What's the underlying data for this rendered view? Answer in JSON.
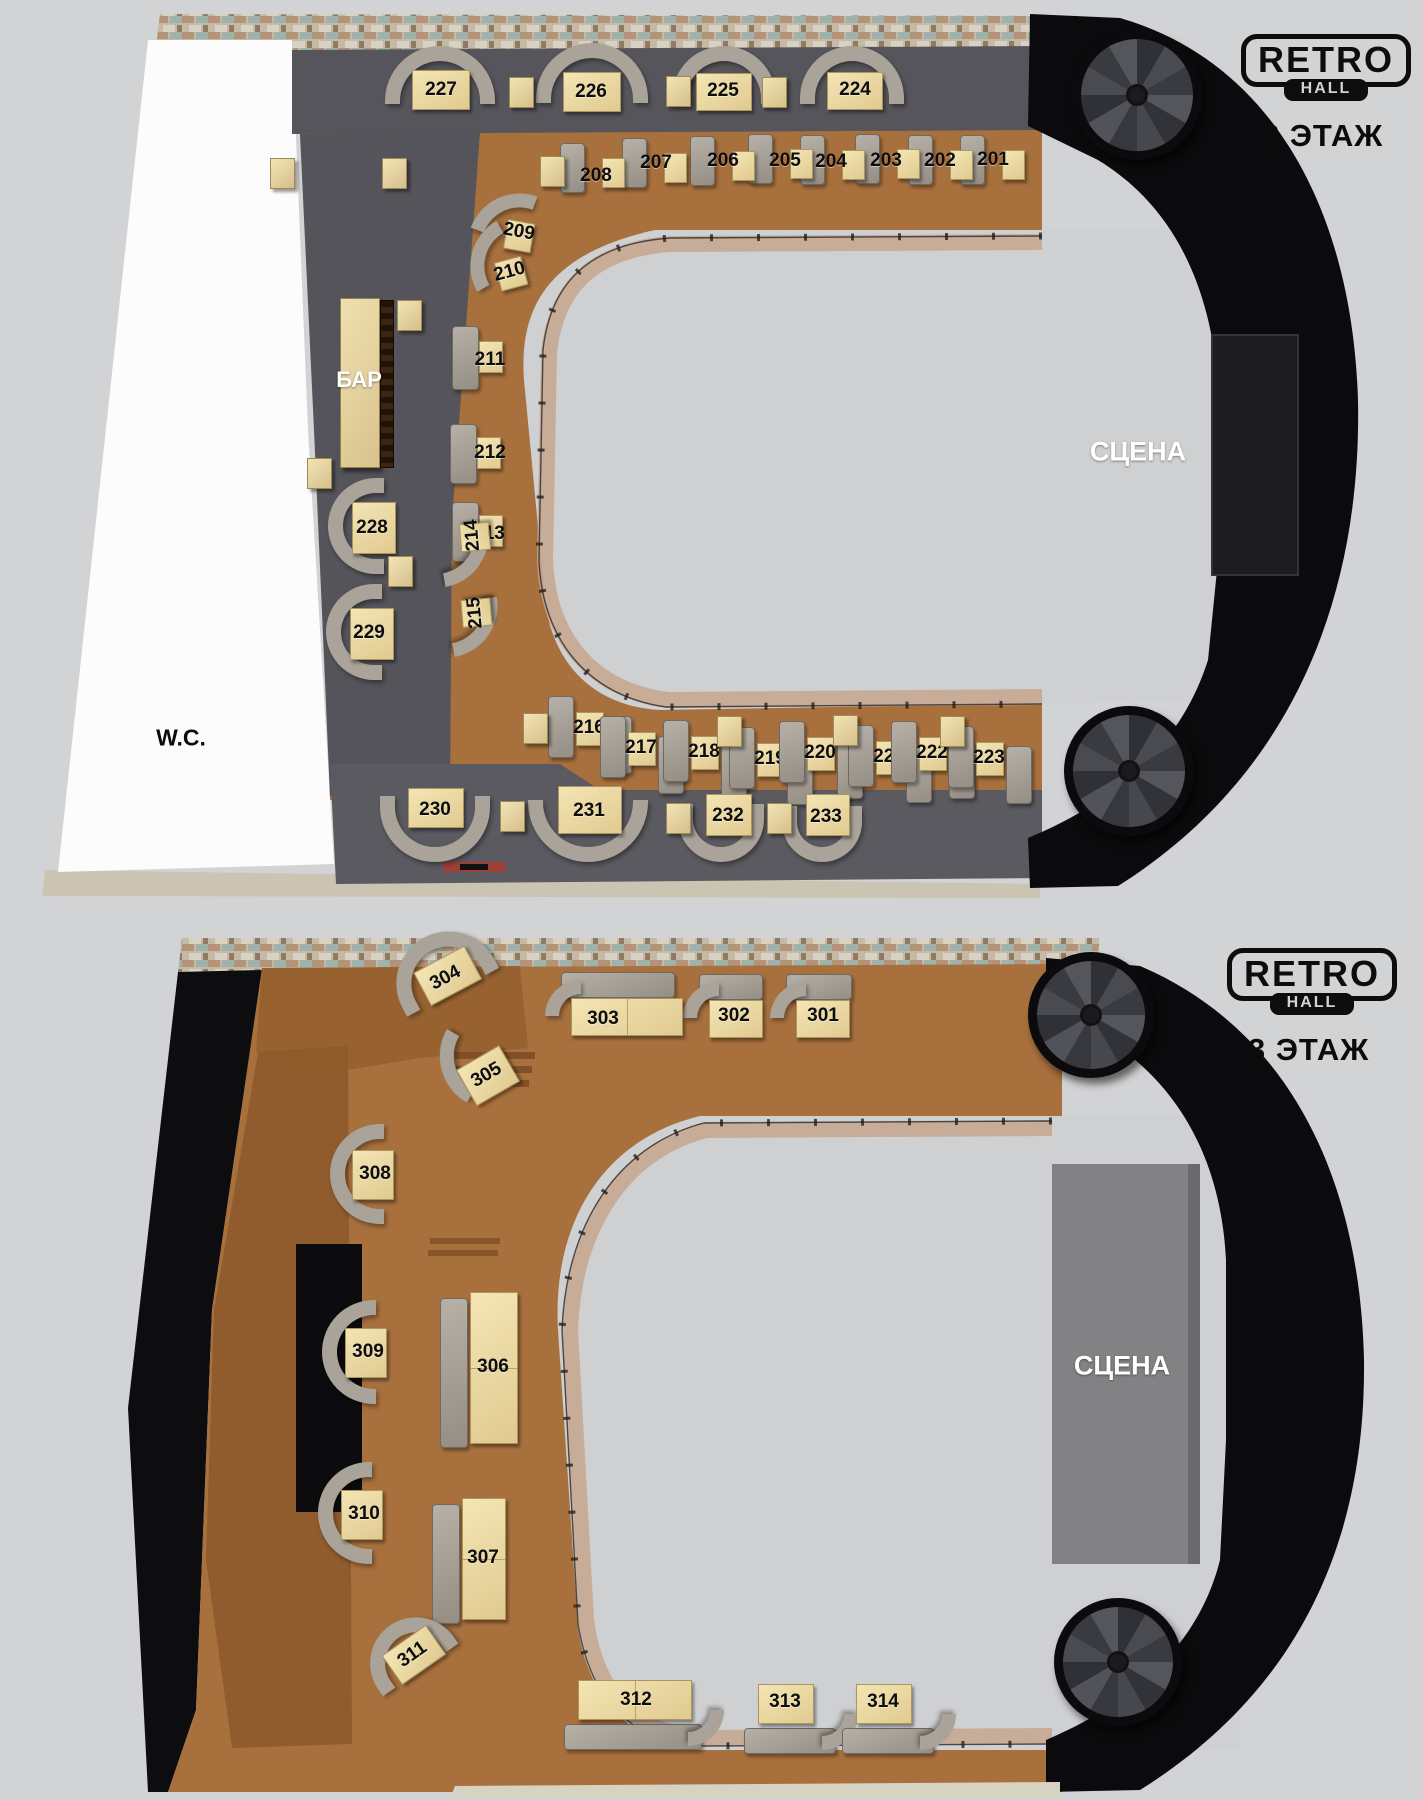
{
  "branding": {
    "logo_line1": "RETRO",
    "logo_line2": "HALL"
  },
  "floors": [
    {
      "id": "floor2",
      "title": "2 ЭТАЖ",
      "labels": {
        "bar": "БАР",
        "wc": "W.C.",
        "stage": "СЦЕНА"
      },
      "tables": [
        {
          "number": "201"
        },
        {
          "number": "202"
        },
        {
          "number": "203"
        },
        {
          "number": "204"
        },
        {
          "number": "205"
        },
        {
          "number": "206"
        },
        {
          "number": "207"
        },
        {
          "number": "208"
        },
        {
          "number": "209"
        },
        {
          "number": "210"
        },
        {
          "number": "211"
        },
        {
          "number": "212"
        },
        {
          "number": "213"
        },
        {
          "number": "214"
        },
        {
          "number": "215"
        },
        {
          "number": "216"
        },
        {
          "number": "217"
        },
        {
          "number": "218"
        },
        {
          "number": "219"
        },
        {
          "number": "220"
        },
        {
          "number": "221"
        },
        {
          "number": "222"
        },
        {
          "number": "223"
        },
        {
          "number": "224"
        },
        {
          "number": "225"
        },
        {
          "number": "226"
        },
        {
          "number": "227"
        },
        {
          "number": "228"
        },
        {
          "number": "229"
        },
        {
          "number": "230"
        },
        {
          "number": "231"
        },
        {
          "number": "232"
        },
        {
          "number": "233"
        }
      ]
    },
    {
      "id": "floor3",
      "title": "3 ЭТАЖ",
      "labels": {
        "stage": "СЦЕНА"
      },
      "tables": [
        {
          "number": "301"
        },
        {
          "number": "302"
        },
        {
          "number": "303"
        },
        {
          "number": "304"
        },
        {
          "number": "305"
        },
        {
          "number": "306"
        },
        {
          "number": "307"
        },
        {
          "number": "308"
        },
        {
          "number": "309"
        },
        {
          "number": "310"
        },
        {
          "number": "311"
        },
        {
          "number": "312"
        },
        {
          "number": "313"
        },
        {
          "number": "314"
        }
      ]
    }
  ],
  "colors": {
    "background": "#d2d3d5",
    "wood_floor": "#a8703d",
    "dark_floor": "#55555b",
    "void": "#cfd0d2",
    "black_structure": "#0b0b0d",
    "sofa": "#a9a399",
    "table": "#ecd9a4",
    "white_area": "#fcfcfc",
    "stage_floor3": "#828285",
    "walkway": "#c5a68e",
    "terrace": "#8e5a2b",
    "brick_wall": "#c6baa6"
  }
}
